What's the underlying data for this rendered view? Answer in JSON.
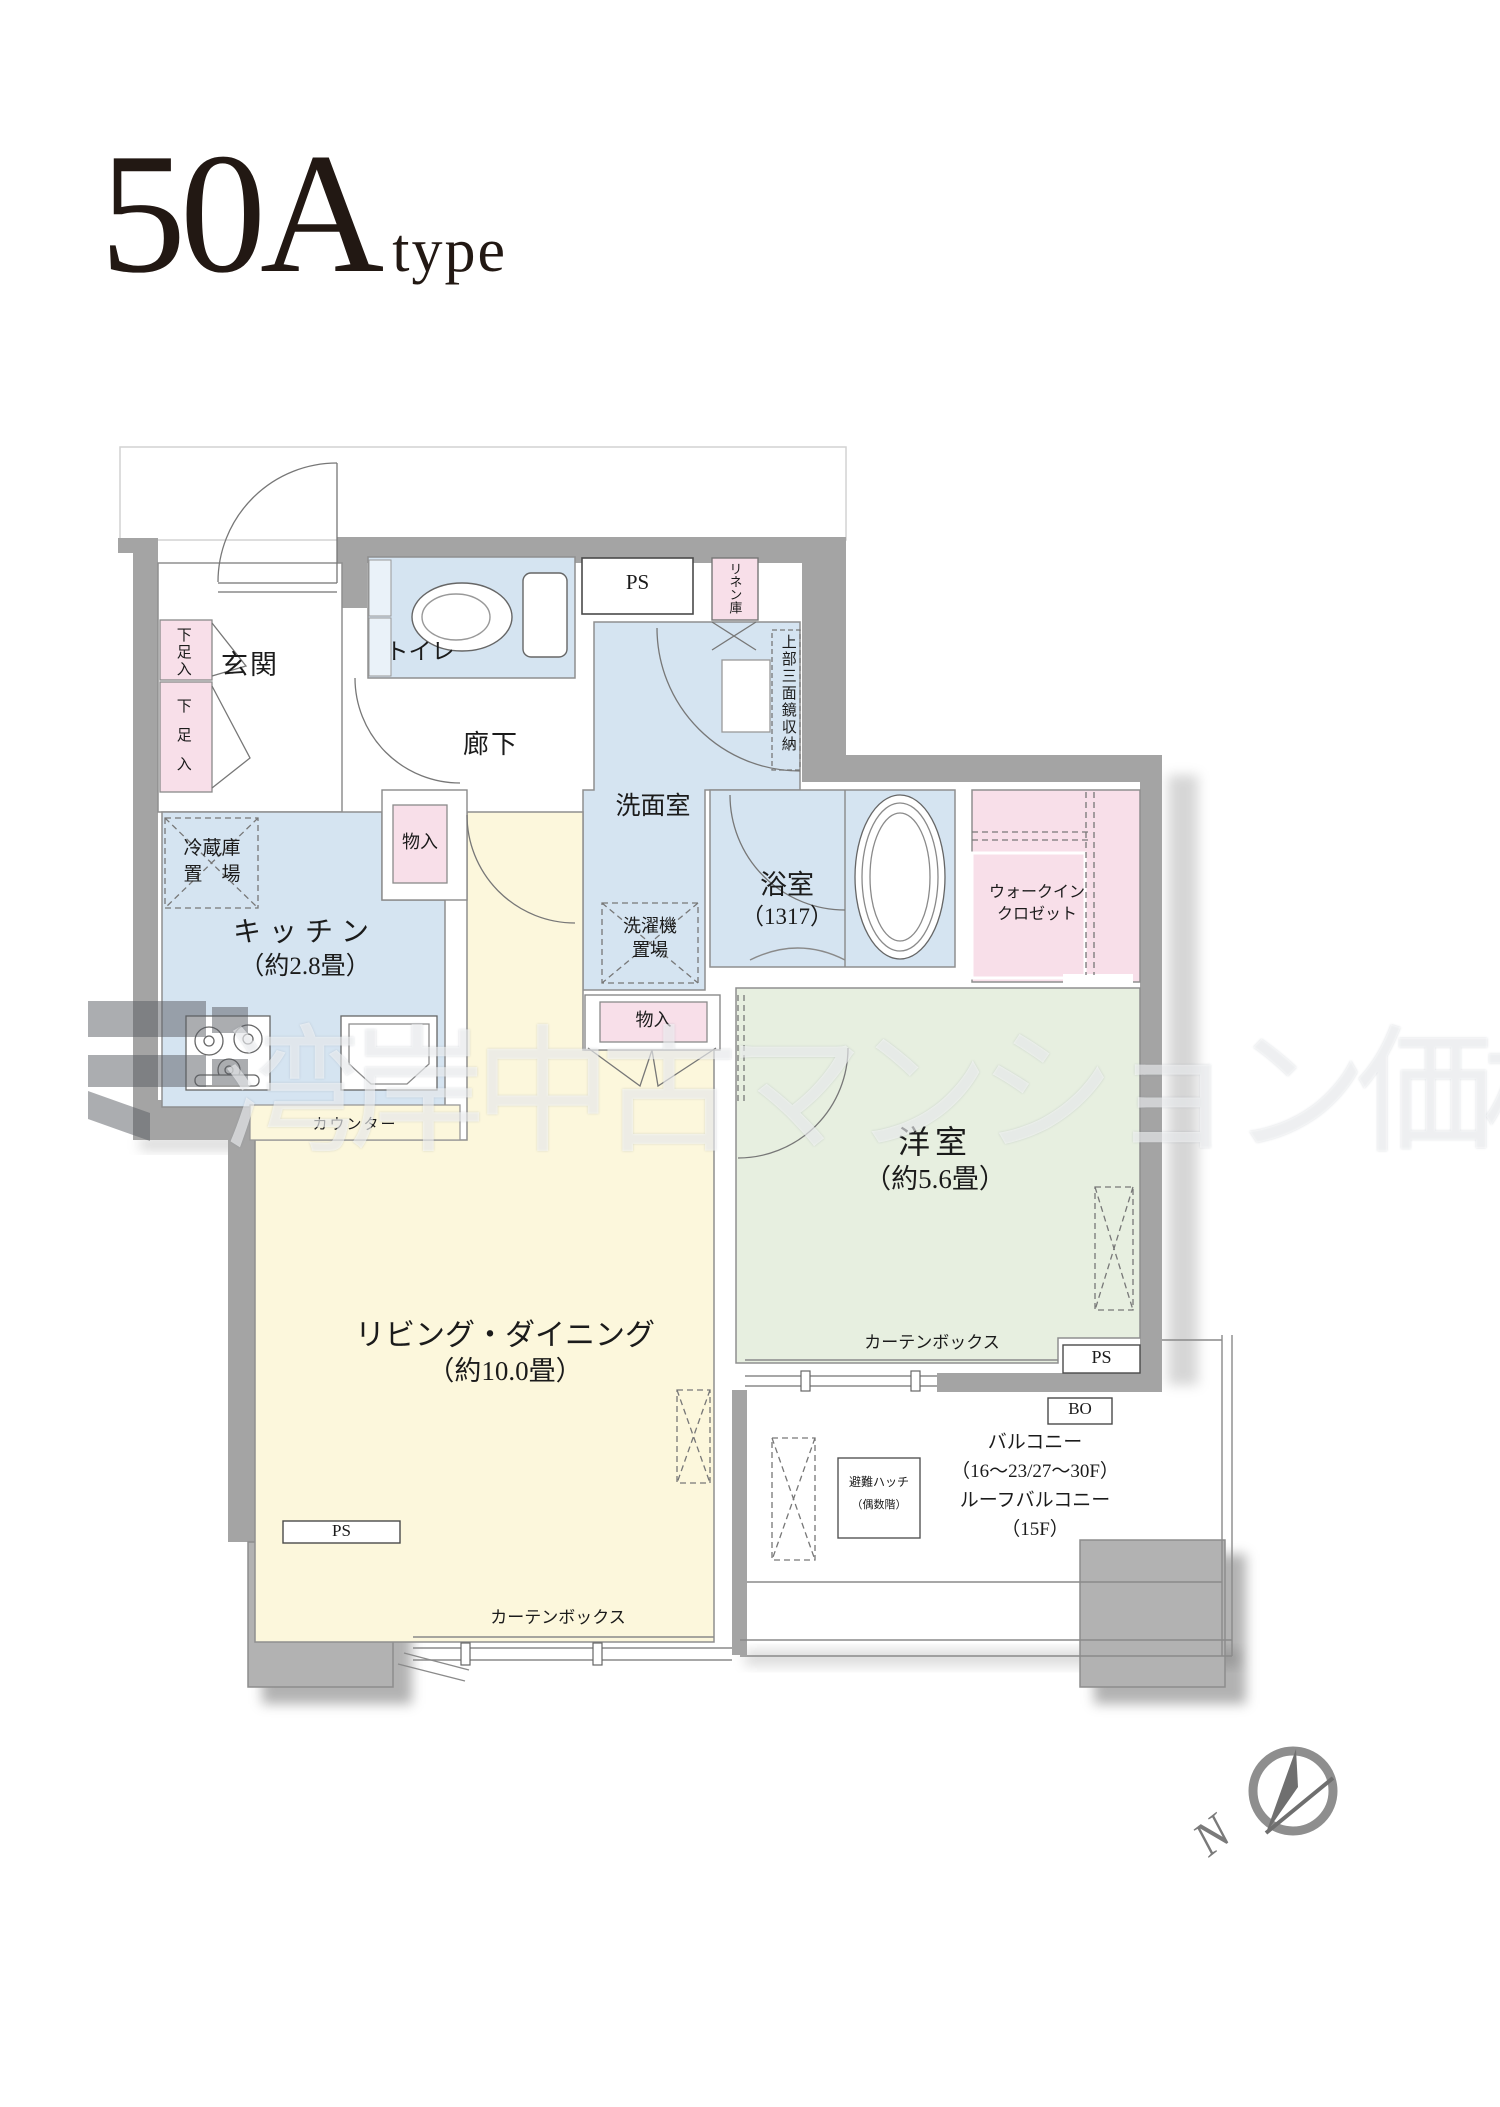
{
  "title": {
    "main": "50A",
    "sub": "type"
  },
  "rooms": {
    "entrance": "玄関",
    "toilet": "トイレ",
    "hallway": "廊下",
    "washroom": "洗面室",
    "bathroom_name": "浴室",
    "bathroom_size": "（1317）",
    "walkin_closet_line1": "ウォークイン",
    "walkin_closet_line2": "クロゼット",
    "kitchen_name": "キッチン",
    "kitchen_size": "（約2.8畳）",
    "living_dining_name": "リビング・ダイニング",
    "living_dining_size": "（約10.0畳）",
    "bedroom_name": "洋室",
    "bedroom_size": "（約5.6畳）"
  },
  "storage": {
    "shoe_cabinet_1": "下足入",
    "shoe_cabinet_2": "下足入",
    "linen_cabinet": "リネン庫",
    "upper_mirror_storage": "上部三面鏡収納",
    "refrigerator_line1": "冷蔵庫",
    "refrigerator_line2": "置　場",
    "washer_line1": "洗濯機",
    "washer_line2": "置場",
    "closet_kitchen": "物入",
    "closet_hall": "物入"
  },
  "fixtures": {
    "counter": "カウンター",
    "curtain_box_bedroom": "カーテンボックス",
    "curtain_box_living": "カーテンボックス",
    "pipe_space_top": "PS",
    "pipe_space_living": "PS",
    "pipe_space_bedroom": "PS",
    "bo": "BO",
    "hatch_line1": "避難ハッチ",
    "hatch_line2": "（偶数階）"
  },
  "balcony": {
    "line1": "バルコニー",
    "line2": "（16〜23/27〜30F）",
    "line3": "ルーフバルコニー",
    "line4": "（15F）"
  },
  "compass": {
    "north": "N"
  },
  "watermark": {
    "text": "湾岸中古マンション価格"
  },
  "colors": {
    "wall": "#a4a4a4",
    "wet_room_blue": "#d5e4f1",
    "storage_pink": "#f8dfe9",
    "living_yellow": "#fcf7dc",
    "bedroom_green": "#e7efe0",
    "pillar": "#b2b2b2"
  }
}
